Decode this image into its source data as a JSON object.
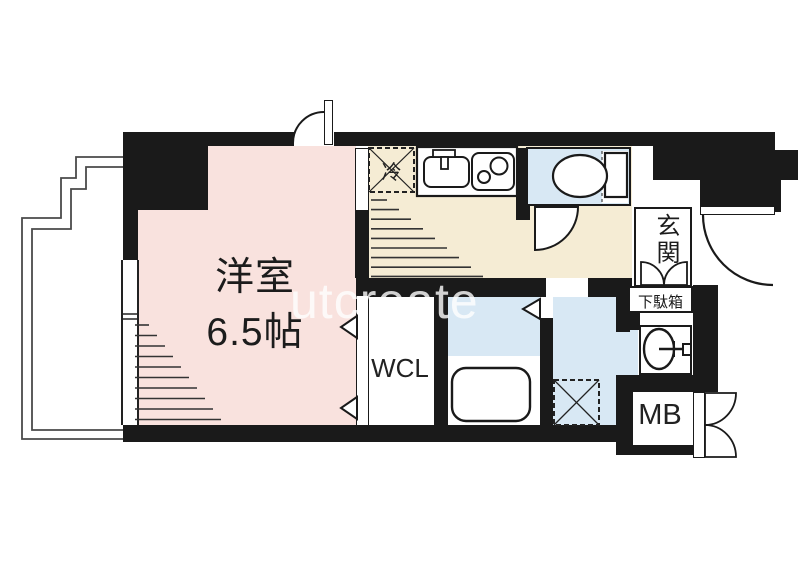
{
  "floorplan": {
    "watermark": "utcreate",
    "rooms": {
      "western": {
        "name_line1": "洋室",
        "name_line2": "6.5帖"
      },
      "wcl": {
        "label": "WCL"
      },
      "meter_box": {
        "label": "MB"
      },
      "entrance": {
        "label": "玄関"
      },
      "shoe_cabinet": {
        "label": "下駄箱"
      },
      "refrigerator": {
        "label": "冷"
      }
    },
    "icons": [
      "toilet-icon",
      "kitchen-sink-icon",
      "faucet-icon",
      "two-burner-stove-icon",
      "bathtub-icon",
      "washbasin-icon",
      "washing-machine-pan-icon",
      "refrigerator-space-icon",
      "entry-door-arc",
      "toilet-door-arc",
      "top-door-arc",
      "mb-double-door",
      "shoe-cabinet-double-door",
      "folding-door-arrow",
      "balcony-railing",
      "window",
      "ceiling-hatch"
    ],
    "colors": {
      "wall": "#1a1a1a",
      "western_room": "#f9e2de",
      "kitchen_hall": "#f5ecd4",
      "wet_area": "#d8e8f4",
      "watermark": "#ffffff"
    }
  }
}
